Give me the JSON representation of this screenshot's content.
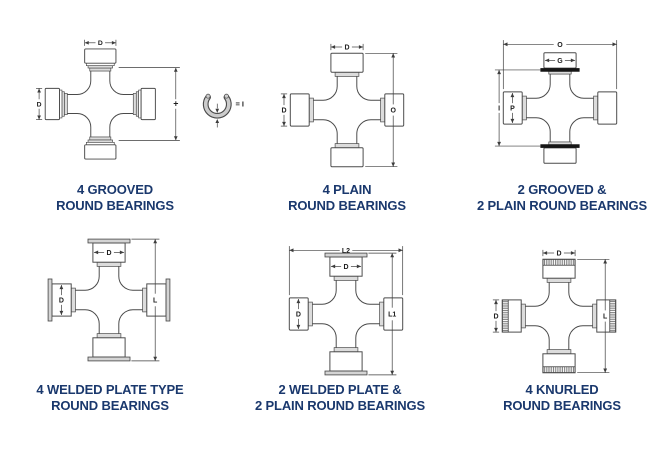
{
  "colors": {
    "caption_text": "#1a386d",
    "line_art": "#4a4a4a",
    "dim_lines": "#3d3d3d",
    "dim_text": "#1c1c1c",
    "shading_gray": "#dcdcdc",
    "snap_ring_black": "#161616"
  },
  "figures": [
    {
      "id": "4-grooved-round-bearings",
      "caption": [
        "4 GROOVED",
        "ROUND BEARINGS"
      ],
      "cups": {
        "vertical": "grooved",
        "horizontal": "grooved"
      },
      "dims": [
        {
          "placement": "above-cup",
          "label": "D"
        },
        {
          "placement": "left-of-cup",
          "label": "D"
        },
        {
          "placement": "right-span-grooves",
          "label": "+"
        },
        {
          "placement": "snap-ring",
          "label": "= I"
        }
      ]
    },
    {
      "id": "4-plain-round-bearings",
      "caption": [
        "4 PLAIN",
        "ROUND BEARINGS"
      ],
      "cups": {
        "vertical": "plain",
        "horizontal": "plain"
      },
      "dims": [
        {
          "placement": "above-cup",
          "label": "D"
        },
        {
          "placement": "left-of-cup",
          "label": "D"
        },
        {
          "placement": "right-span-cups",
          "label": "O"
        }
      ]
    },
    {
      "id": "2-grooved-2-plain-round-bearings",
      "caption": [
        "2 GROOVED &",
        "2 PLAIN ROUND BEARINGS"
      ],
      "cups": {
        "vertical": "grooved_black",
        "horizontal": "plain"
      },
      "dims": [
        {
          "placement": "top-span-cups",
          "label": "O"
        },
        {
          "placement": "inside-top-cup",
          "label": "G"
        },
        {
          "placement": "left-span-rings",
          "label": "I"
        },
        {
          "placement": "inside-left-cup",
          "label": "P"
        }
      ]
    },
    {
      "id": "4-welded-plate-round-bearings",
      "caption": [
        "4 WELDED PLATE TYPE",
        "ROUND BEARINGS"
      ],
      "cups": {
        "vertical": "welded",
        "horizontal": "welded"
      },
      "dims": [
        {
          "placement": "inside-top-cup",
          "label": "D"
        },
        {
          "placement": "inside-left-cup",
          "label": "D"
        },
        {
          "placement": "right-span-plates",
          "label": "L"
        }
      ]
    },
    {
      "id": "2-welded-2-plain-round-bearings",
      "caption": [
        "2 WELDED PLATE &",
        "2 PLAIN ROUND BEARINGS"
      ],
      "cups": {
        "vertical": "welded",
        "horizontal": "plain"
      },
      "dims": [
        {
          "placement": "top-span-cups",
          "label": "L2"
        },
        {
          "placement": "inside-top-cup",
          "label": "D"
        },
        {
          "placement": "inside-left-cup",
          "label": "D"
        },
        {
          "placement": "right-span-plates",
          "label": "L1"
        }
      ]
    },
    {
      "id": "4-knurled-round-bearings",
      "caption": [
        "4 KNURLED",
        "ROUND BEARINGS"
      ],
      "cups": {
        "vertical": "knurled",
        "horizontal": "knurled"
      },
      "dims": [
        {
          "placement": "above-cup",
          "label": "D"
        },
        {
          "placement": "left-of-cup",
          "label": "D"
        },
        {
          "placement": "right-span-cups",
          "label": "L"
        }
      ]
    }
  ]
}
